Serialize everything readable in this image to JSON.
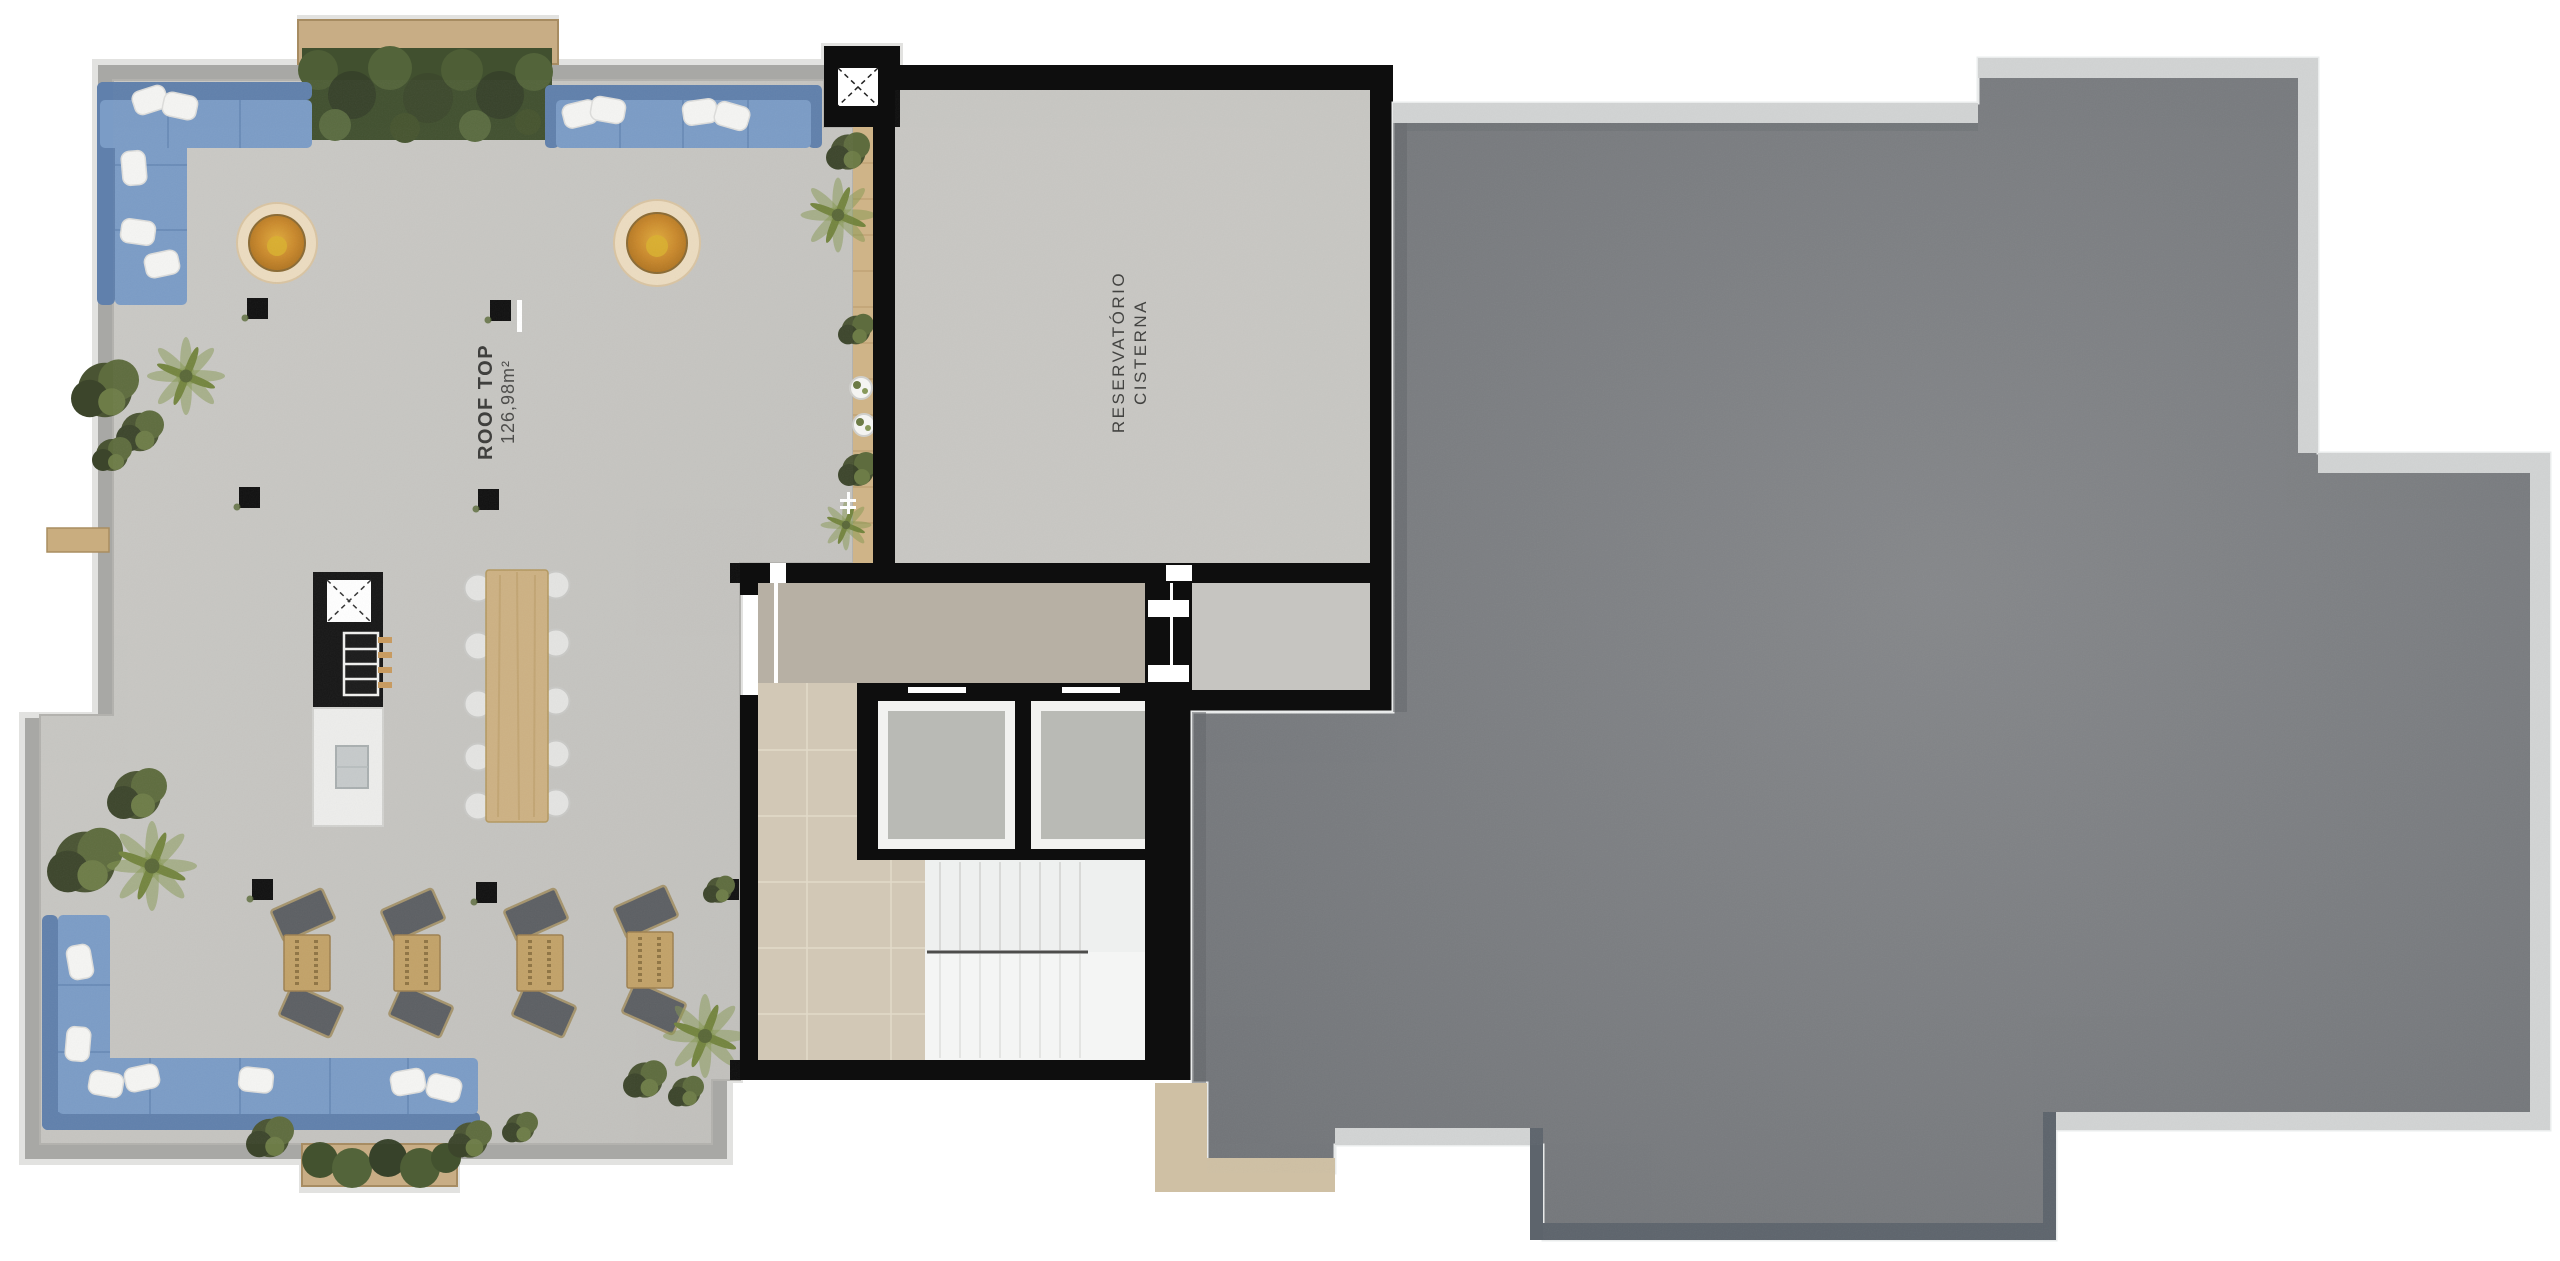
{
  "plan": {
    "rooftop_label": {
      "title": "ROOF TOP",
      "area": "126,98m²"
    },
    "cisterna_label": {
      "line1": "RESERVATÓRIO",
      "line2": "CISTERNA"
    }
  },
  "colors": {
    "background": "#ffffff",
    "terrace_floor": "#c7c6c2",
    "parapet_gray": "#a8a8a5",
    "parapet_edge_light": "#e2e2e0",
    "wall_black": "#0e0e0e",
    "roof_slab": "#7c7e81",
    "roof_parapet_light": "#d2d4d4",
    "roof_edge_dark": "#5d646c",
    "walkway_tan": "#cfc0a4",
    "sofa_blue": "#7b9cc6",
    "sofa_blue_dark": "#6080ac",
    "pillow_white": "#f5f5f3",
    "hedge_green": "#41502f",
    "plant_green": "#73824b",
    "wood": "#cdb183",
    "firepit_amber": "#c9882b",
    "corridor_tile": "#d2c8b6",
    "lobby_gray": "#b7b0a4",
    "stair_white": "#eef0ef",
    "elevator_cab_gray": "#b9bab5",
    "lounge_chair_gray": "#5c5f63",
    "rattan": "#c2a268"
  }
}
